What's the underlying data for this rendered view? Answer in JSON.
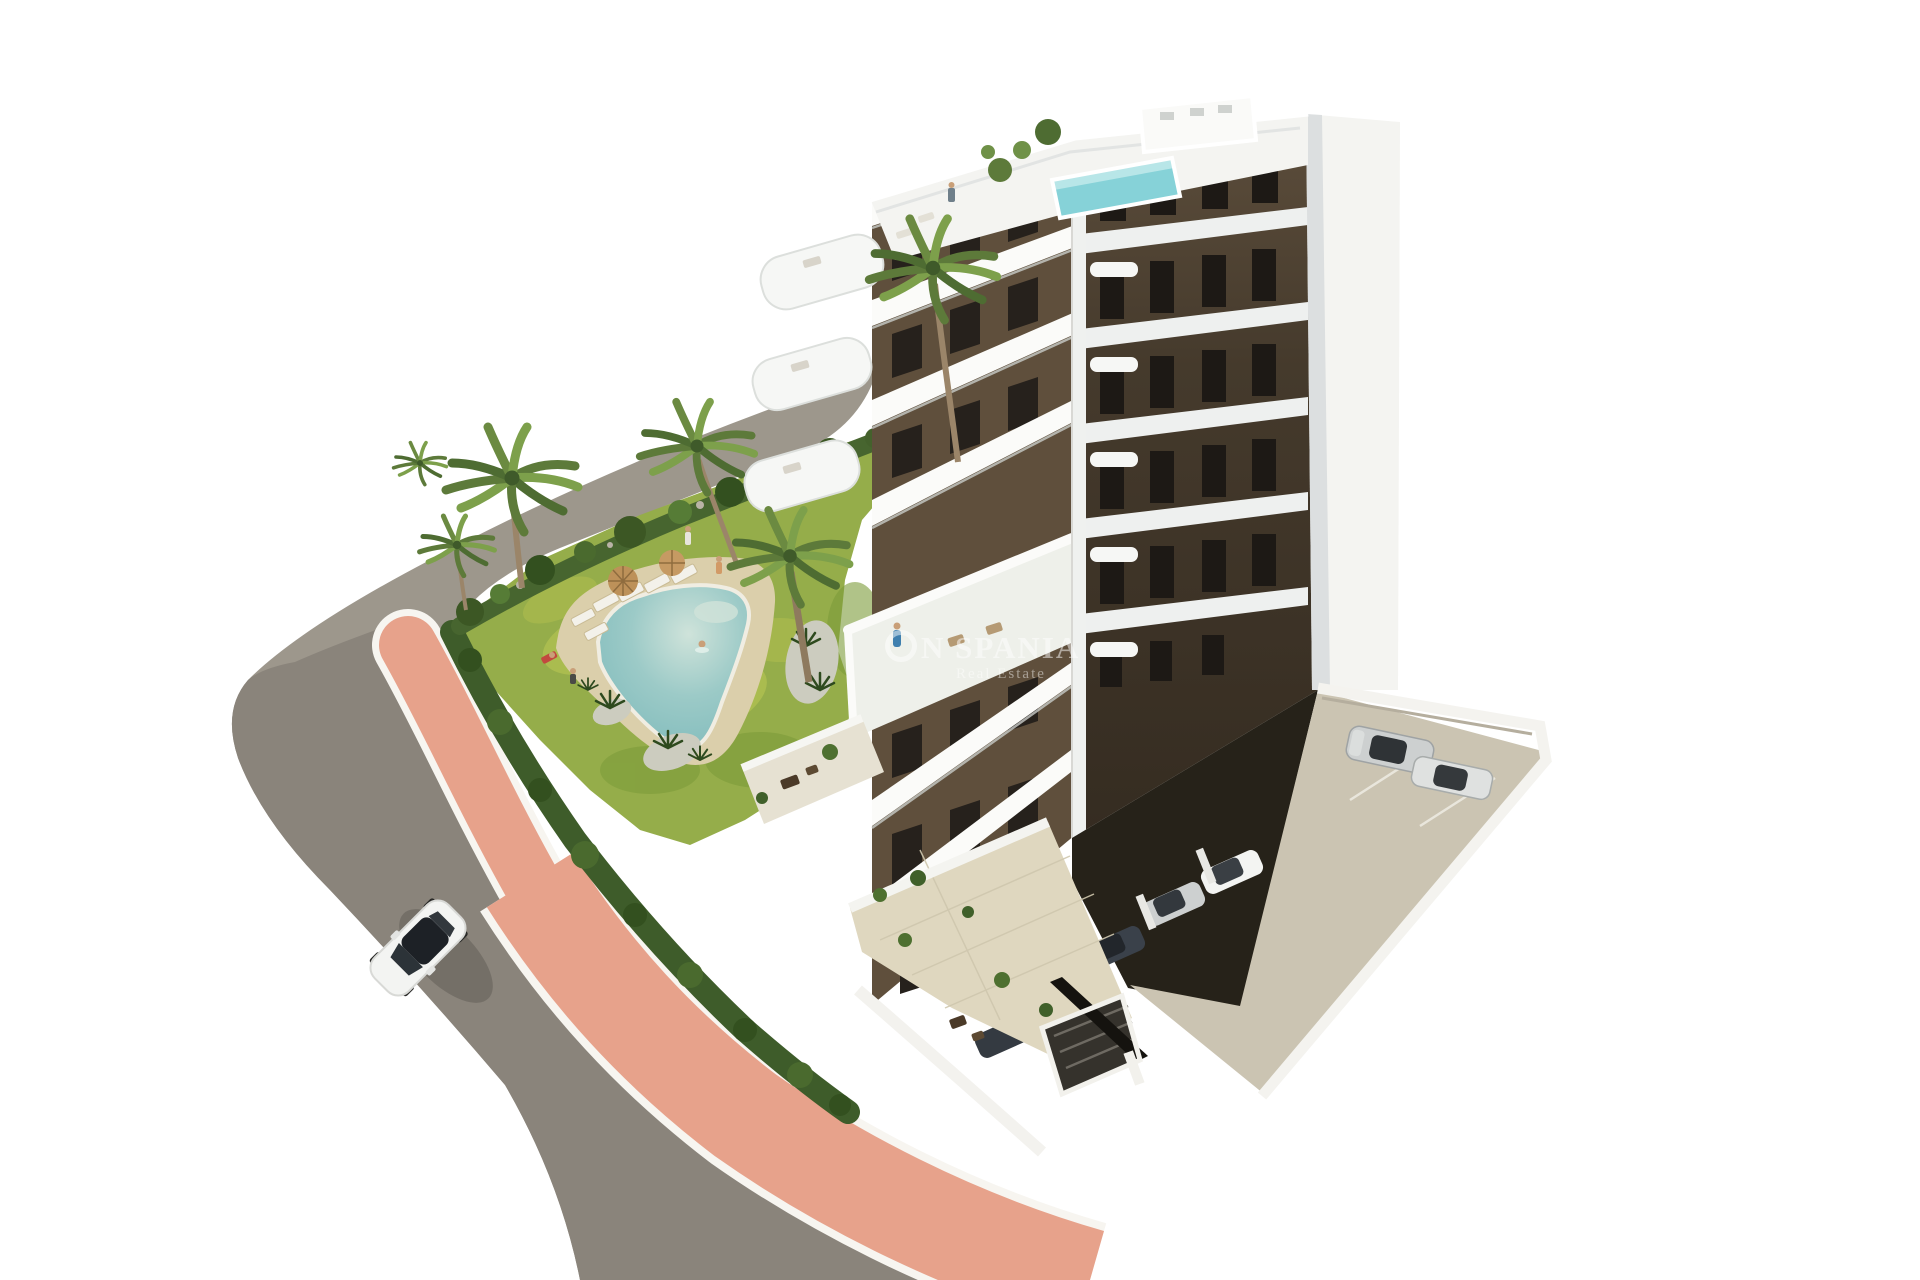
{
  "canvas": {
    "width": 1920,
    "height": 1280,
    "background": "#ffffff"
  },
  "watermark": {
    "logo_mark": "circle-logo",
    "text": "N SPANIA",
    "subtitle": "Real Estate",
    "color": "#ffffff",
    "opacity": 0.5
  },
  "scene": {
    "description": "Aerial 3D architectural rendering of a modern white apartment building with dark-brown accent walls, curved white balconies, a rooftop terrace with small pool, a landscaped garden with free-form swimming pool, sun loungers, parasols and palm trees, a salmon-pink pedestrian walkway along a curved asphalt road with one white car, and a private parking lot with parked cars and a garage ramp.",
    "objects": [
      "apartment-building",
      "rooftop-terrace",
      "rooftop-pool",
      "balconies",
      "big-terrace",
      "garden",
      "swimming-pool",
      "pool-deck",
      "sun-loungers",
      "parasols",
      "palm-trees",
      "hedge",
      "promenade",
      "pink-walkway",
      "asphalt-road",
      "white-car",
      "parking-lot",
      "parked-cars",
      "garage-ramp",
      "ground-floor-terraces",
      "perimeter-wall",
      "tiny-people"
    ]
  },
  "palette": {
    "background": "#ffffff",
    "promenade": "#9d978c",
    "road": "#8a847b",
    "walkway_pink": "#e7a28b",
    "curb_white": "#f7f5f0",
    "lawn": "#95ad4a",
    "lawn_light": "#b9c653",
    "lawn_dark": "#7d9c3a",
    "hedge": "#3e5c2a",
    "shrub_dark": "#33501f",
    "pool_water": "#93c6c4",
    "pool_deck": "#dbcfab",
    "building_white": "#f4f4f1",
    "slab_white": "#fbfbf9",
    "wall_brown": "#5f4f3c",
    "wall_brown_dark": "#453a2c",
    "window_dark": "#26211c",
    "undercroft": "#262219",
    "concrete": "#cbc4b2",
    "terrace_cream": "#dfd7bf",
    "roof_pool": "#86d2d8",
    "car_white": "#f3f4f2",
    "car_silver": "#cdd0d0",
    "car_dark": "#3a414a",
    "palm_trunk": "#9b8569",
    "frond_green": "#5d7a3a"
  }
}
